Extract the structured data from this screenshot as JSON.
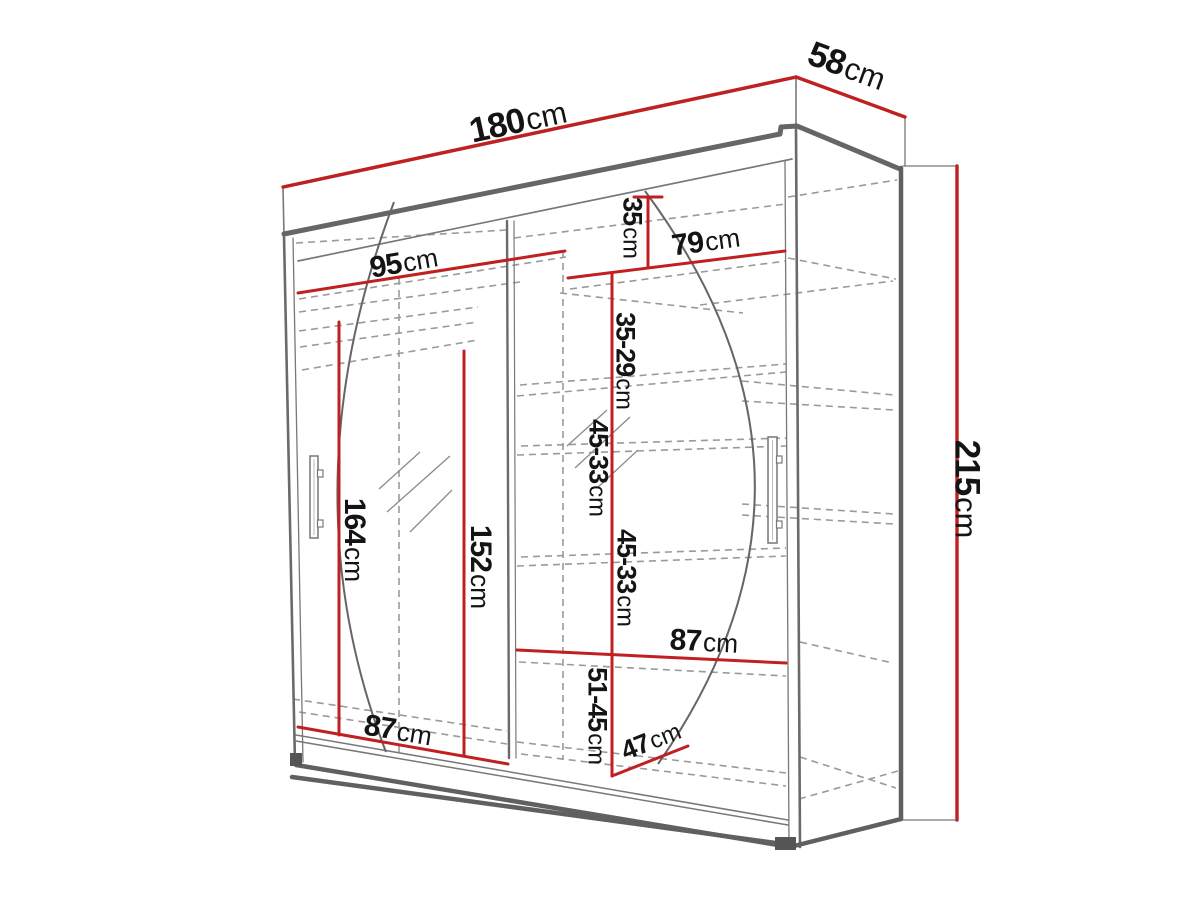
{
  "diagram": {
    "type": "furniture-dimension-drawing",
    "subject": "sliding-door wardrobe with mirror, perspective view with shelf layout",
    "unit_default": "cm",
    "colors": {
      "dimension_line": "#c02020",
      "structure_line": "#6e6e6e",
      "dashed_shelf_line": "#9a9a9a",
      "label_text": "#141414",
      "background": "#ffffff"
    },
    "dimensions": {
      "total_width": {
        "value": "180",
        "unit": "cm"
      },
      "total_depth": {
        "value": "58",
        "unit": "cm"
      },
      "total_height": {
        "value": "215",
        "unit": "cm"
      },
      "left_section_width": {
        "value": "95",
        "unit": "cm"
      },
      "right_section_width": {
        "value": "79",
        "unit": "cm"
      },
      "top_shelf_space": {
        "value": "35",
        "unit": "cm"
      },
      "shelf_space_1": {
        "value": "35-29",
        "unit": "cm"
      },
      "shelf_space_2": {
        "value": "45-33",
        "unit": "cm"
      },
      "shelf_space_3": {
        "value": "45-33",
        "unit": "cm"
      },
      "bottom_shelf_space": {
        "value": "51-45",
        "unit": "cm"
      },
      "shelf_depth": {
        "value": "47",
        "unit": "cm"
      },
      "right_shelf_width": {
        "value": "87",
        "unit": "cm"
      },
      "left_shelf_width": {
        "value": "87",
        "unit": "cm"
      },
      "left_hanging_height": {
        "value": "164",
        "unit": "cm"
      },
      "mid_hanging_height": {
        "value": "152",
        "unit": "cm"
      }
    }
  }
}
